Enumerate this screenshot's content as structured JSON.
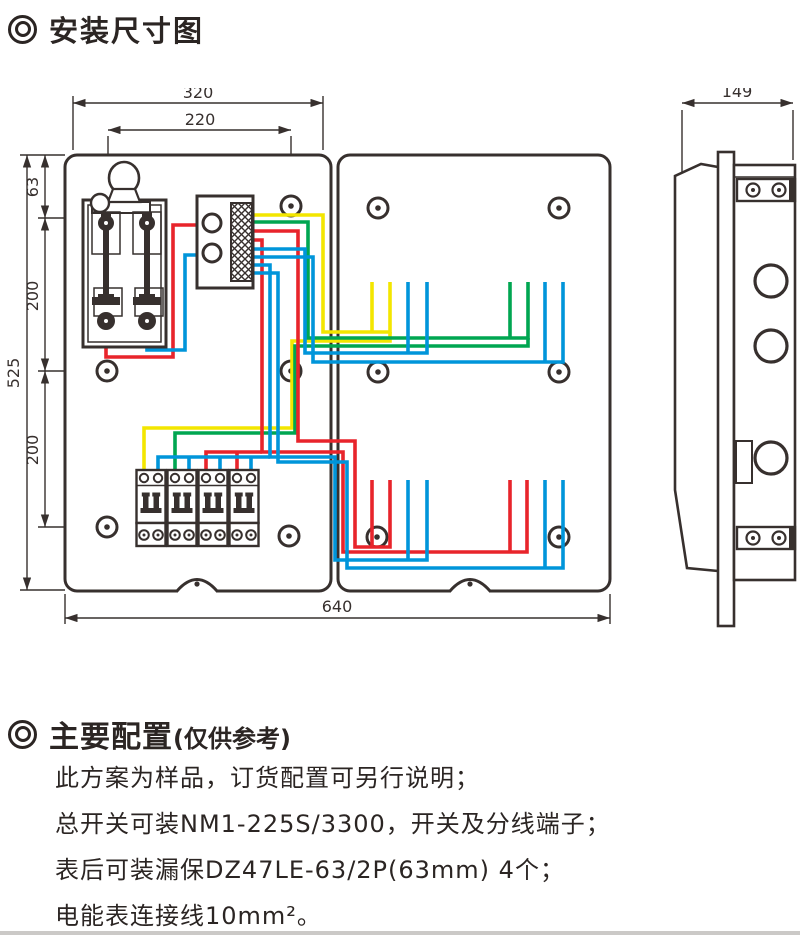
{
  "sections": {
    "dim_title": "安装尺寸图",
    "config_title": "主要配置",
    "config_subtitle": "(仅供参考)",
    "config_lines": [
      "此方案为样品，订货配置可另行说明；",
      "总开关可装NM1-225S/3300，开关及分线端子；",
      "表后可装漏保DZ47LE-63/2P(63mm) 4个；",
      "电能表连接线10mm²。"
    ]
  },
  "diagram": {
    "dimensions": {
      "top_outer": "320",
      "top_inner": "220",
      "left_top": "63",
      "left_mid": "200",
      "left_bottom": "200",
      "left_overall": "525",
      "bottom_width": "640",
      "side_depth": "149"
    },
    "wire_colors": {
      "yellow": "#f3e600",
      "green": "#00a651",
      "red": "#e8242b",
      "blue": "#0095da"
    },
    "line_color": "#37302e",
    "components": {
      "main_switch": "knife-switch",
      "terminal_block": "wiring-terminal-block",
      "breakers": "4 two-pole circuit breakers",
      "views": [
        "front-view",
        "side-view"
      ]
    }
  }
}
